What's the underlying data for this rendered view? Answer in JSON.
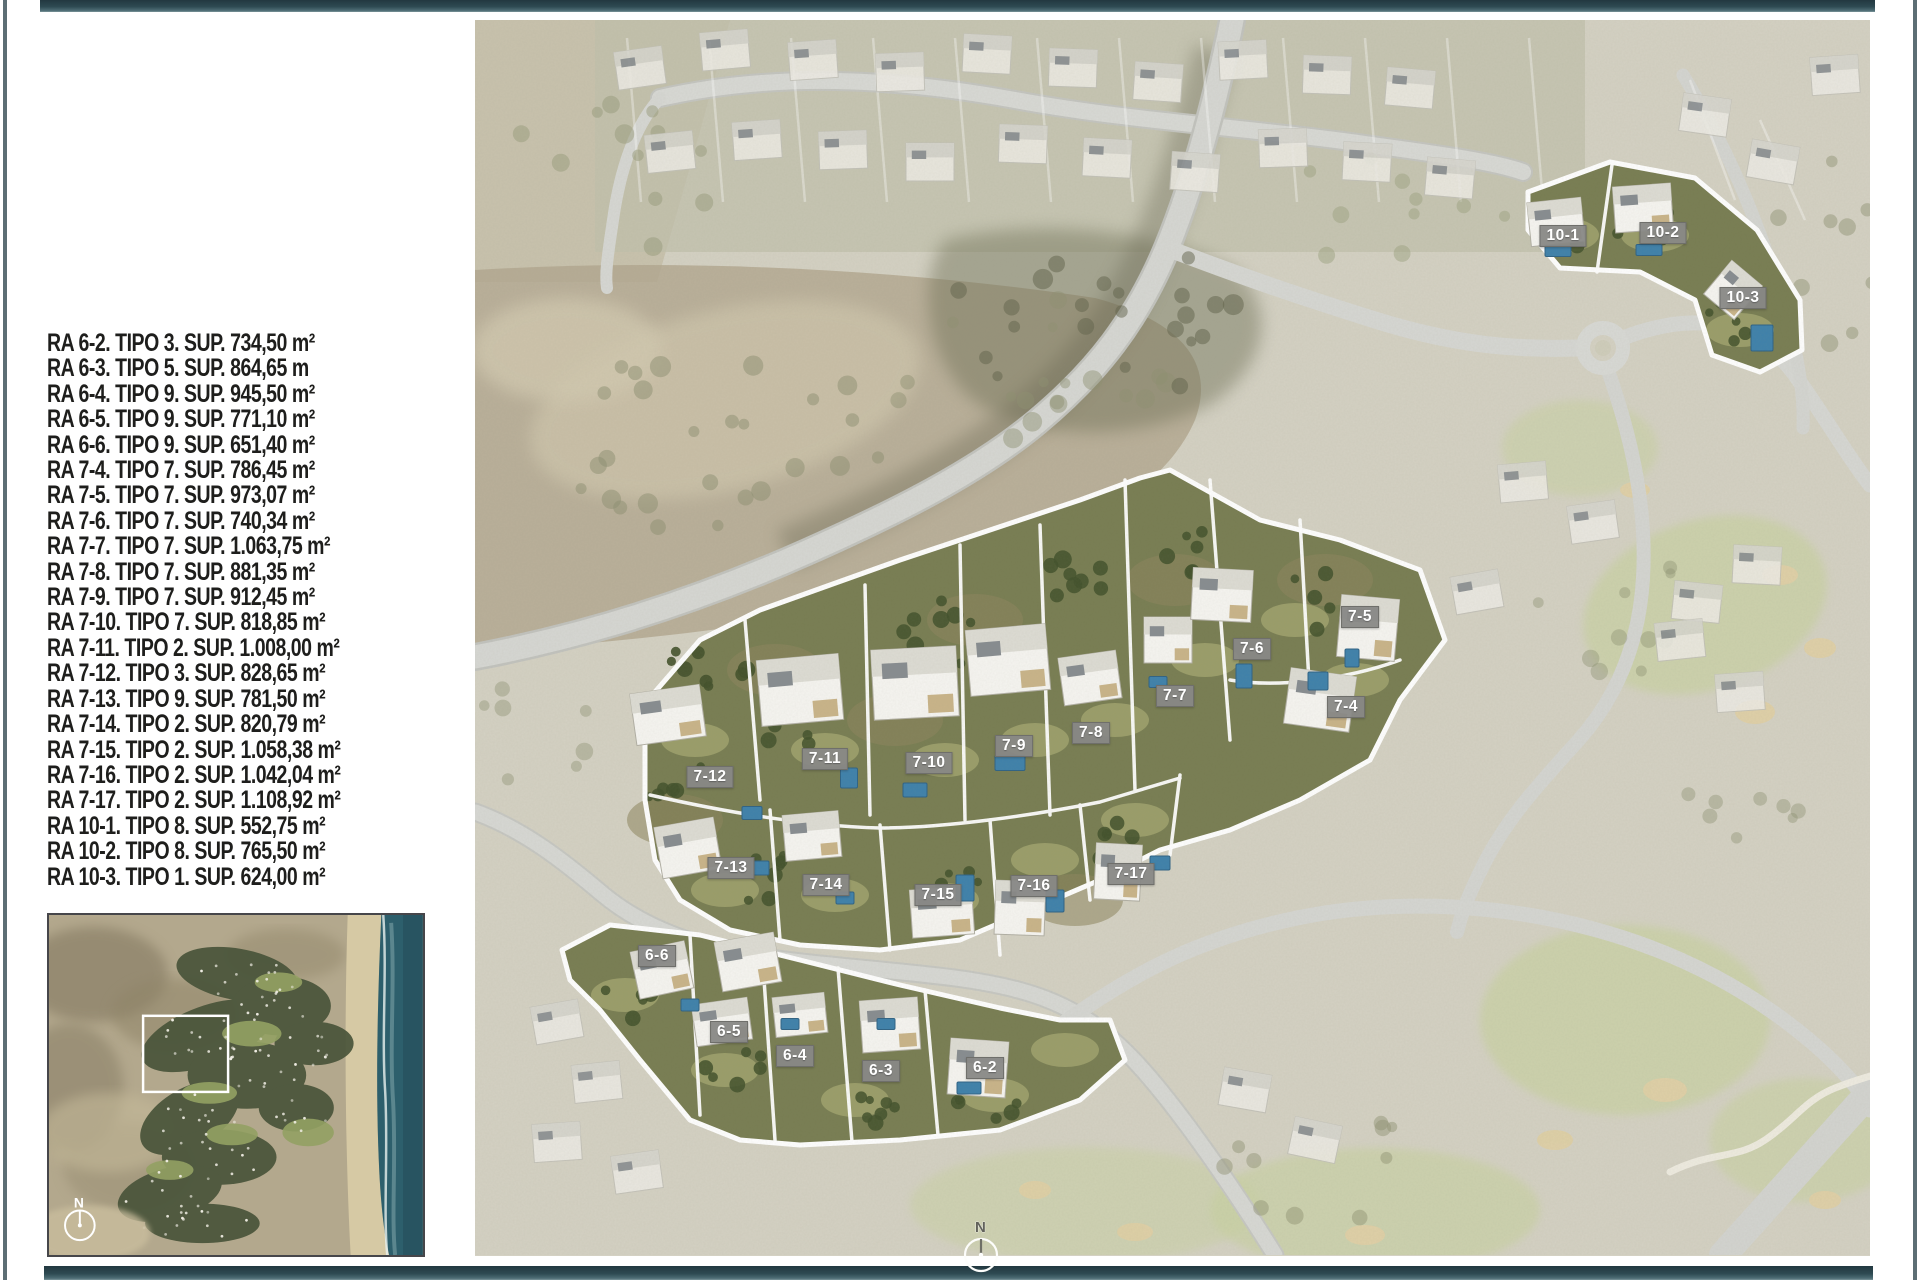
{
  "page": {
    "background": "#ffffff",
    "accent_bar_color": "#2e4a52",
    "edge_line_color": "#5c6e74"
  },
  "legend": {
    "items": [
      "RA 6-2. TIPO 3. SUP. 734,50 m²",
      "RA 6-3. TIPO 5. SUP. 864,65 m",
      "RA 6-4. TIPO 9. SUP. 945,50 m²",
      "RA 6-5. TIPO 9. SUP. 771,10 m²",
      "RA 6-6. TIPO 9. SUP. 651,40 m²",
      "RA 7-4. TIPO 7. SUP. 786,45 m²",
      "RA 7-5. TIPO 7. SUP. 973,07 m²",
      "RA 7-6. TIPO 7. SUP. 740,34 m²",
      "RA 7-7. TIPO 7. SUP. 1.063,75 m²",
      "RA 7-8. TIPO 7. SUP. 881,35 m²",
      "RA 7-9. TIPO 7. SUP. 912,45 m²",
      "RA 7-10. TIPO 7. SUP. 818,85 m²",
      "RA 7-11. TIPO 2. SUP. 1.008,00 m²",
      "RA 7-12. TIPO 3. SUP. 828,65 m²",
      "RA 7-13. TIPO 9. SUP. 781,50 m²",
      "RA 7-14. TIPO 2. SUP. 820,79 m²",
      "RA 7-15. TIPO 2. SUP. 1.058,38 m²",
      "RA 7-16. TIPO 2. SUP. 1.042,04 m²",
      "RA 7-17. TIPO 2. SUP. 1.108,92 m²",
      "RA 10-1. TIPO 8. SUP. 552,75 m²",
      "RA 10-2. TIPO 8. SUP. 765,50 m²",
      "RA 10-3. TIPO 1. SUP. 624,00 m²"
    ],
    "text_color": "#1e1e1c"
  },
  "map": {
    "north_label": "N",
    "label_bg": "#888886",
    "label_text_color": "#ffffff",
    "highlight_outline": "#ffffff",
    "pool_color": "#3e81ab",
    "plot_labels": [
      {
        "id": "10-1",
        "x": 1563,
        "y": 236
      },
      {
        "id": "10-2",
        "x": 1663,
        "y": 233
      },
      {
        "id": "10-3",
        "x": 1743,
        "y": 298
      },
      {
        "id": "7-5",
        "x": 1360,
        "y": 617
      },
      {
        "id": "7-6",
        "x": 1252,
        "y": 649
      },
      {
        "id": "7-7",
        "x": 1175,
        "y": 696
      },
      {
        "id": "7-4",
        "x": 1346,
        "y": 707
      },
      {
        "id": "7-8",
        "x": 1091,
        "y": 733
      },
      {
        "id": "7-9",
        "x": 1014,
        "y": 746
      },
      {
        "id": "7-10",
        "x": 929,
        "y": 763
      },
      {
        "id": "7-11",
        "x": 825,
        "y": 759
      },
      {
        "id": "7-12",
        "x": 710,
        "y": 777
      },
      {
        "id": "7-13",
        "x": 731,
        "y": 868
      },
      {
        "id": "7-14",
        "x": 826,
        "y": 885
      },
      {
        "id": "7-15",
        "x": 938,
        "y": 895
      },
      {
        "id": "7-16",
        "x": 1034,
        "y": 886
      },
      {
        "id": "7-17",
        "x": 1131,
        "y": 874
      },
      {
        "id": "6-6",
        "x": 657,
        "y": 956
      },
      {
        "id": "6-5",
        "x": 729,
        "y": 1032
      },
      {
        "id": "6-4",
        "x": 795,
        "y": 1056
      },
      {
        "id": "6-3",
        "x": 881,
        "y": 1071
      },
      {
        "id": "6-2",
        "x": 985,
        "y": 1068
      }
    ]
  },
  "inset": {
    "north_label": "N",
    "ocean_color": "#2d5f6c"
  }
}
